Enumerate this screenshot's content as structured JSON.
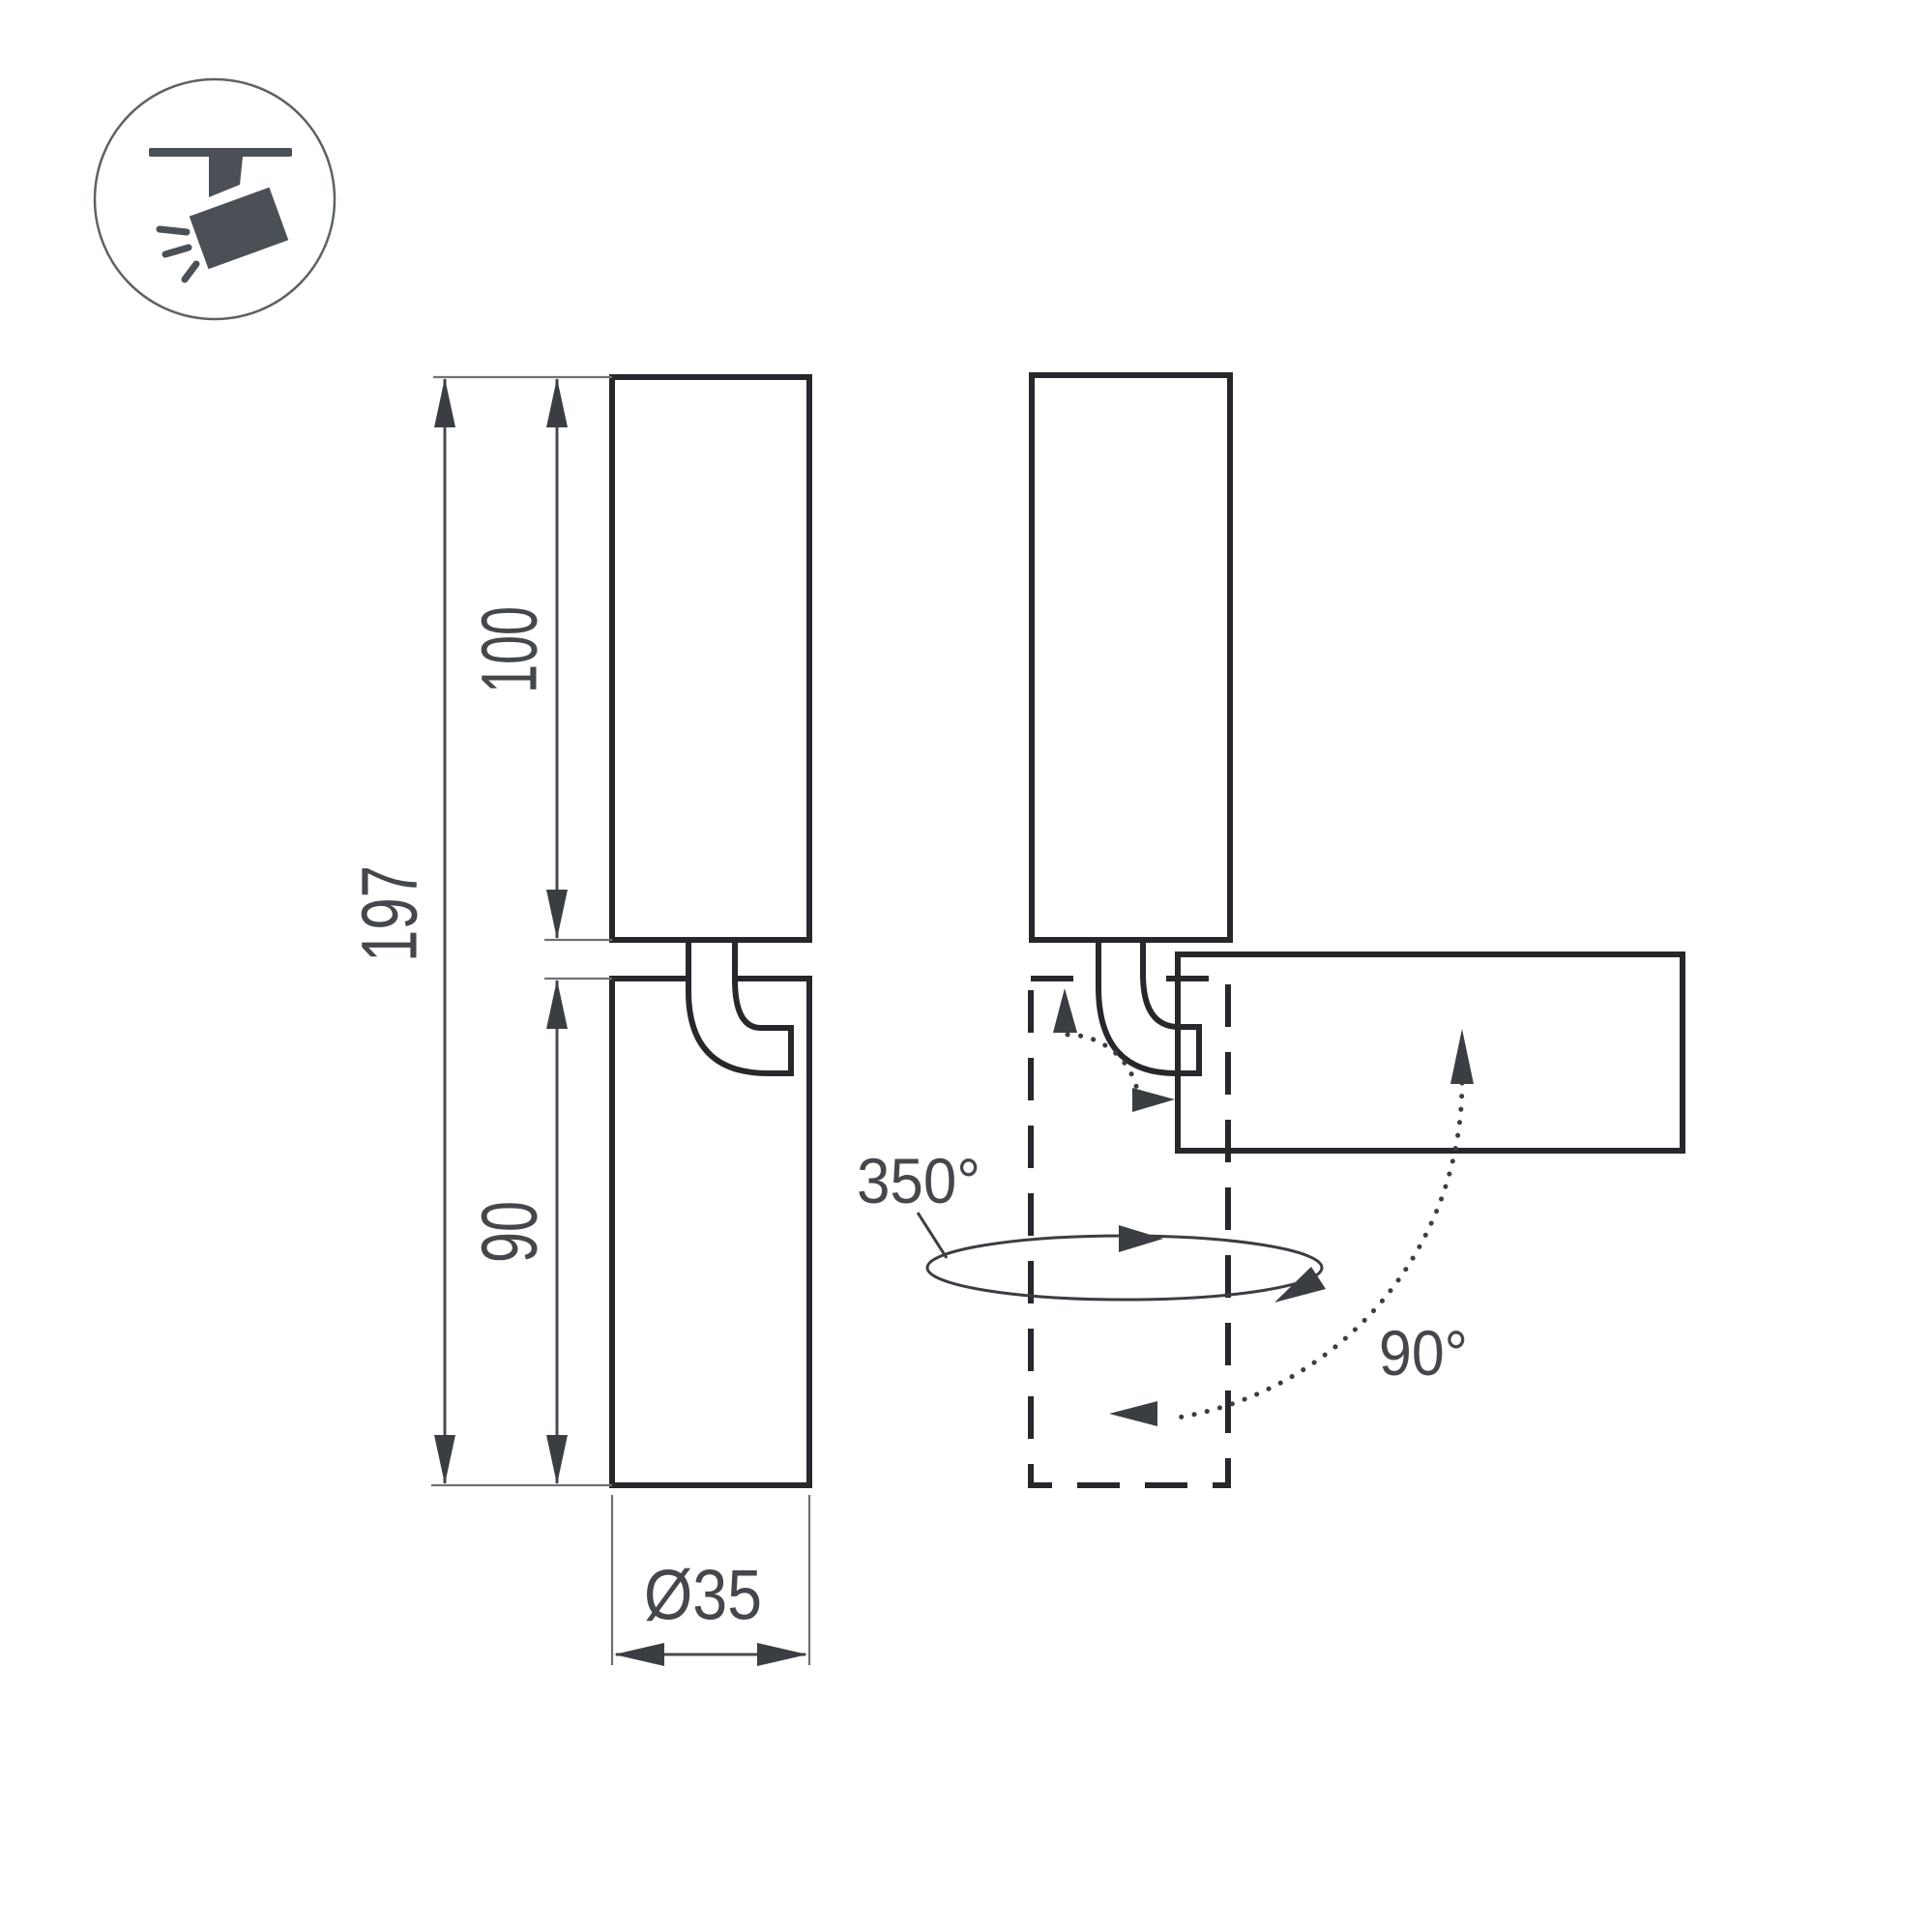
{
  "page": {
    "background": "#ffffff",
    "kind": "technical-dimension-drawing",
    "subject": "track-mounted swivel spotlight"
  },
  "badge": {
    "icon": "track-spotlight-icon"
  },
  "labels": {
    "total_height": "197",
    "upper_body_length": "100",
    "head_length": "90",
    "diameter": "Ø35",
    "swivel_angle": "350°",
    "tilt_angle": "90°"
  },
  "colors": {
    "outline": "#26282b",
    "dimension_line": "#474b4e",
    "extension_line": "#6f7275",
    "arrow": "#3a3e42",
    "text": "#44474b",
    "icon": "#4a5056",
    "badge_ring": "#5d6266",
    "background": "#ffffff"
  }
}
